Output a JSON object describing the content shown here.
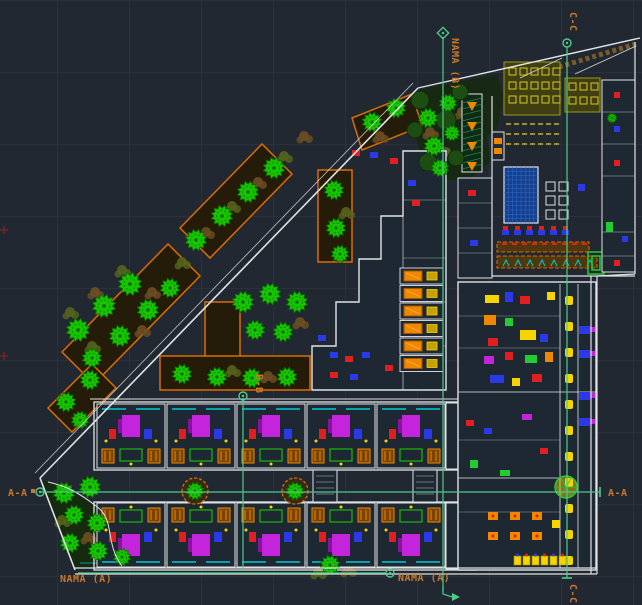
{
  "viewport": {
    "type": "cad-model-space",
    "background": "#222831",
    "grid_color": "#2a313d"
  },
  "labels": {
    "cc_top": "C-C",
    "cc_bottom": "C-C",
    "nama_b": "NAMA (B)",
    "bb": "B-B",
    "aa_left": "A-A",
    "aa_right": "A-A",
    "nama_a_left": "NAMA (A)",
    "nama_a_right": "NAMA (A)"
  },
  "colors": {
    "label": "#c87a2a",
    "section_line": "#4ecb8a",
    "outline": "#dfe3e6",
    "fill_building": "#1e2833",
    "tree": "#17c400",
    "tree_stroke": "#0a6e00",
    "tree_dark": "#1d4d12",
    "shrub": "#6e4f23",
    "shrub_alt": "#57641c",
    "planter": "#d96d00",
    "planter_fill": "#241c08",
    "pool": "#17408c",
    "pool_line": "#2f6ad0",
    "glazing": "#00c8d2",
    "magenta": "#c324dc",
    "magenta_dark": "#8a12a0",
    "red": "#e02020",
    "blue": "#2a3ae8",
    "yellow": "#f5d400",
    "orange": "#ee8800",
    "orange_dark": "#7a4400",
    "green": "#22cc33",
    "rug_green": "#1ad400",
    "olive": "#3f3f12",
    "olive_line": "#d8c81e",
    "hedge": "#7a5a28",
    "ramp_green": "#1d8a3a",
    "frame_tick": "#7a2222"
  }
}
